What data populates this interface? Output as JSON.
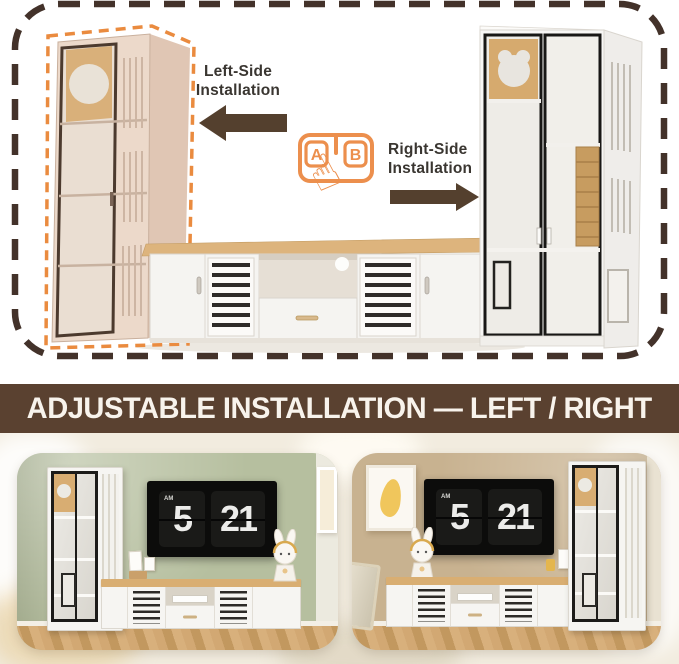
{
  "diagram": {
    "left_label": "Left-Side Installation",
    "right_label": "Right-Side Installation",
    "keycap_a": "A",
    "keycap_b": "B",
    "hand_icon": "☝",
    "accent_orange": "#ec8f4d",
    "arrow_color": "#54402e",
    "dash_border_color": "#43322a"
  },
  "banner": {
    "text": "ADJUSTABLE INSTALLATION — LEFT / RIGHT",
    "bg_color": "#5a4130",
    "text_color": "#f8f3ec"
  },
  "scenes": {
    "left": {
      "wall_color": "#b6bf9f",
      "clock": {
        "meridiem": "AM",
        "hour": "5",
        "minute": "21"
      }
    },
    "right": {
      "wall_color": "#c8b290",
      "clock": {
        "meridiem": "AM",
        "hour": "5",
        "minute": "21"
      }
    }
  }
}
